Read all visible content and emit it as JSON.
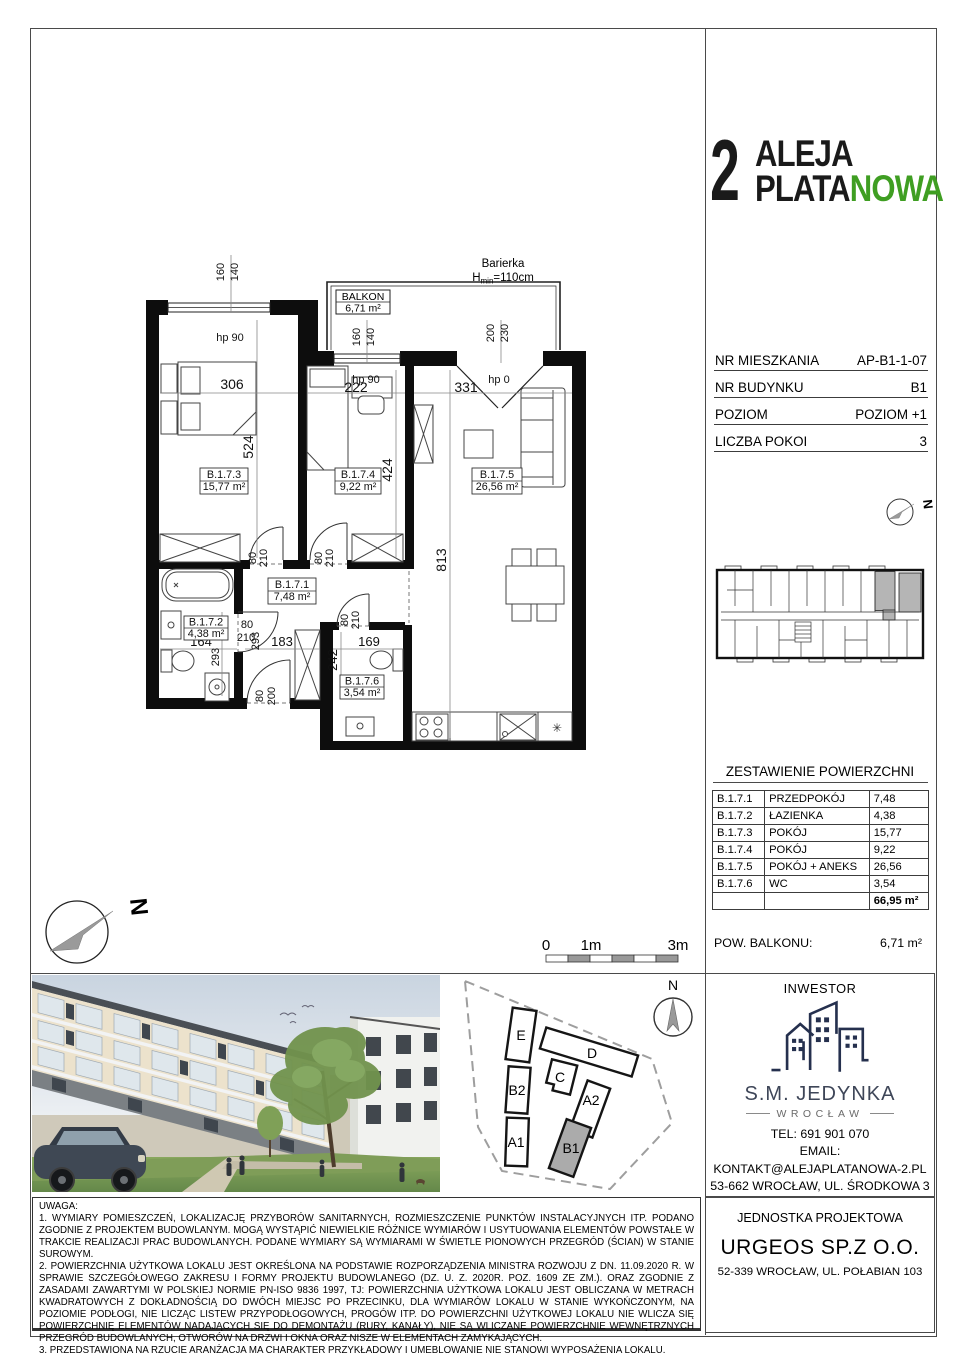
{
  "logo": {
    "number": "2",
    "line1": "ALEJA",
    "line2a": "PLATA",
    "line2b": "NOWA",
    "green": "#3f9e22"
  },
  "info": {
    "rows": [
      {
        "label": "NR MIESZKANIA",
        "value": "AP-B1-1-07"
      },
      {
        "label": "NR BUDYNKU",
        "value": "B1"
      },
      {
        "label": "POZIOM",
        "value": "POZIOM +1"
      },
      {
        "label": "LICZBA POKOI",
        "value": "3"
      }
    ]
  },
  "area_table": {
    "title": "ZESTAWIENIE POWIERZCHNI",
    "rows": [
      {
        "id": "B.1.7.1",
        "name": "PRZEDPOKÓJ",
        "area": "7,48",
        "area_m2": "7,48 m²"
      },
      {
        "id": "B.1.7.2",
        "name": "ŁAZIENKA",
        "area": "4,38",
        "area_m2": "4,38 m²"
      },
      {
        "id": "B.1.7.3",
        "name": "POKÓJ",
        "area": "15,77",
        "area_m2": "15,77 m²"
      },
      {
        "id": "B.1.7.4",
        "name": "POKÓJ",
        "area": "9,22",
        "area_m2": "9,22 m²"
      },
      {
        "id": "B.1.7.5",
        "name": "POKÓJ + ANEKS",
        "area": "26,56",
        "area_m2": "26,56 m²"
      },
      {
        "id": "B.1.7.6",
        "name": "WC",
        "area": "3,54",
        "area_m2": "3,54 m²"
      }
    ],
    "total": "66,95 m²"
  },
  "balcony_row": {
    "label": "POW. BALKONU:",
    "value": "6,71 m²"
  },
  "plan": {
    "north": "N",
    "balkon": {
      "title": "BALKON",
      "area": "6,71 m²"
    },
    "barierka": {
      "line1": "Barierka",
      "h": "H",
      "sub": "min",
      "rest": "=110cm"
    },
    "dims": {
      "win1a": "160",
      "win1b": "140",
      "hp90_1": "hp 90",
      "d306": "306",
      "d524": "524",
      "win2a": "160",
      "win2b": "140",
      "hp90_2": "hp 90",
      "d222": "222",
      "win3a": "200",
      "win3b": "230",
      "hp0": "hp 0",
      "d331": "331",
      "d424": "424",
      "d813": "813",
      "door3_80": "80",
      "door3_210": "210",
      "door4_80": "80",
      "door4_210": "210",
      "wc_80": "80",
      "wc_210": "210",
      "bath_80": "80",
      "bath_210": "210",
      "bath_293": "293",
      "v293": "293",
      "d164": "164",
      "d183": "183",
      "d169": "169",
      "d242": "242",
      "ent_80": "80",
      "ent_200": "200"
    }
  },
  "scale_bar": {
    "zero": "0",
    "one": "1m",
    "three": "3m"
  },
  "site_map": {
    "north": "N",
    "buildings": [
      {
        "label": "E"
      },
      {
        "label": "D"
      },
      {
        "label": "C"
      },
      {
        "label": "B2"
      },
      {
        "label": "A2"
      },
      {
        "label": "A1"
      },
      {
        "label": "B1"
      }
    ]
  },
  "investor": {
    "title": "INWESTOR",
    "name": "S.M. JEDYNKA",
    "city": "WROCŁAW",
    "tel": "TEL: 691 901 070",
    "email_label": "EMAIL:",
    "email": "KONTAKT@ALEJAPLATANOWA-2.PL",
    "address": "53-662 WROCŁAW, UL. ŚRODKOWA 3"
  },
  "design_unit": {
    "title": "JEDNOSTKA PROJEKTOWA",
    "name": "URGEOS SP.Z O.O.",
    "address": "52-339 WROCŁAW, UL. POŁABIAN 103"
  },
  "notes": {
    "title": "UWAGA:",
    "items": [
      "1. WYMIARY POMIESZCZEŃ, LOKALIZACJĘ PRZYBORÓW SANITARNYCH, ROZMIESZCZENIE PUNKTÓW INSTALACYJNYCH ITP. PODANO ZGODNIE Z PROJEKTEM BUDOWLANYM. MOGĄ WYSTĄPIĆ NIEWIELKIE RÓŻNICE WYMIARÓW I USYTUOWANIA ELEMENTÓW POWSTAŁE W TRAKCIE REALIZACJI PRAC BUDOWLANYCH. PODANE WYMIARY SĄ WYMIARAMI W ŚWIETLE PIONOWYCH PRZEGRÓD (ŚCIAN) W STANIE SUROWYM.",
      "2. POWIERZCHNIA UŻYTKOWA LOKALU JEST OKREŚLONA NA PODSTAWIE ROZPORZĄDZENIA MINISTRA ROZWOJU Z DN. 11.09.2020 R. W SPRAWIE SZCZEGÓŁOWEGO ZAKRESU I FORMY PROJEKTU BUDOWLANEGO (DZ. U. Z. 2020R. POZ. 1609 ZE ZM.). ORAZ ZGODNIE Z ZASADAMI ZAWARTYMI W POLSKIEJ NORMIE PN-ISO 9836 1997, TJ: POWIERZCHNIA UŻYTKOWA LOKALU JEST OBLICZANA W METRACH KWADRATOWYCH Z DOKŁADNOŚCIĄ DO DWÓCH MIEJSC PO PRZECINKU, DLA WYMIARÓW LOKALU W STANIE WYKOŃCZONYM, NA POZIOMIE PODŁOGI, NIE LICZĄC LISTEW PRZYPODŁOGOWYCH, PROGÓW ITP. DO POWIERZCHNI UŻYTKOWEJ LOKALU NIE WLICZA SIĘ POWIERZCHNIĘ ELEMENTÓW NADAJĄCYCH SIĘ DO DEMONTAŻU (RURY, KANAŁY), NIE SĄ WLICZANE POWIERZCHNIE WEWNĘTRZNYCH PRZEGRÓD BUDOWLANYCH, OTWORÓW NA DRZWI I OKNA ORAZ NISZE W ELEMENTACH ZAMYKAJĄCYCH.",
      "3. PRZEDSTAWIONA NA RZUCIE ARANŻACJA MA CHARAKTER PRZYKŁADOWY I UMEBLOWANIE NIE STANOWI WYPOSAŻENIA LOKALU."
    ]
  }
}
